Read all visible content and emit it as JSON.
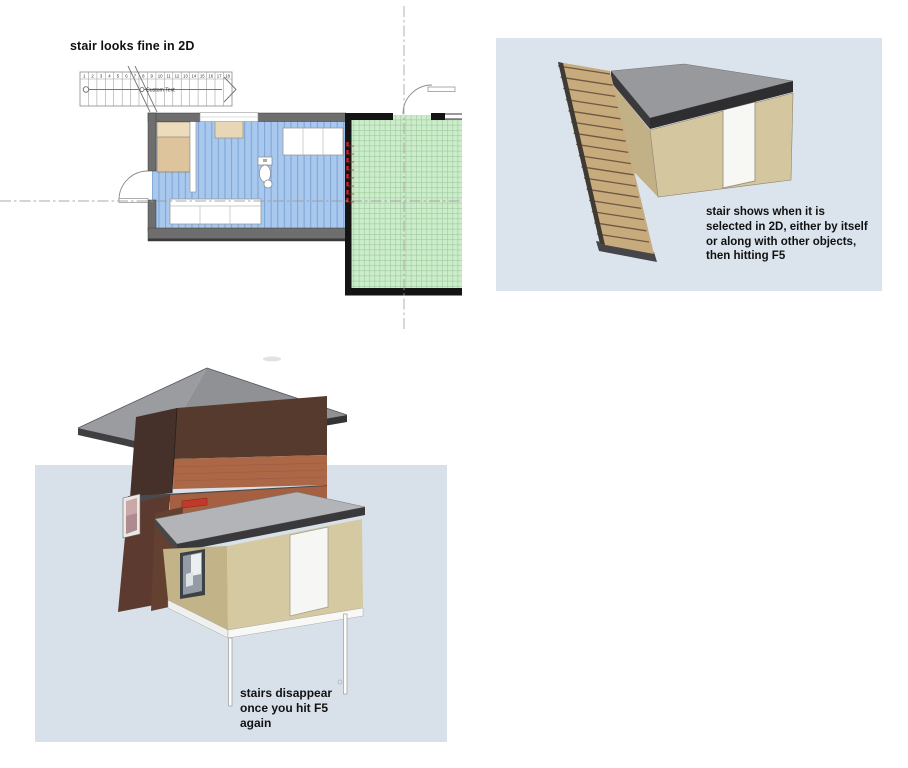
{
  "page": {
    "background": "#ffffff"
  },
  "plan_panel": {
    "title": "stair looks fine in 2D",
    "stair": {
      "label": "Custom Text",
      "tread_numbers": [
        "1",
        "2",
        "3",
        "4",
        "5",
        "6",
        "7",
        "8",
        "9",
        "10",
        "11",
        "12",
        "13",
        "14",
        "15",
        "16",
        "17",
        "18"
      ]
    }
  },
  "render_panel_top": {
    "caption_lines": [
      "stair shows when it is",
      "selected in 2D, either by itself",
      "or along with other objects,",
      "then hitting F5"
    ]
  },
  "render_panel_bottom": {
    "caption_lines": [
      "stairs disappear",
      "once you hit F5",
      "again"
    ]
  },
  "colors": {
    "panel_background": "#dbe3ec",
    "floor_blue": "#a9c8ed",
    "floor_stripe": "#7fa6d6",
    "tile_green": "#cdeccb",
    "tile_grid": "#9acb9a",
    "wall_gray": "#6e6e6e",
    "wall_black": "#141414",
    "selection_red": "#c62222",
    "wood_tread": "#c7ab7d",
    "roof_gray": "#97999c",
    "fascia_dark": "#3a3a3c",
    "stucco_light": "#d5c9a2",
    "stucco_shade": "#c3b389",
    "brick_dark": "#563a2d",
    "brick_light": "#ac6747"
  }
}
